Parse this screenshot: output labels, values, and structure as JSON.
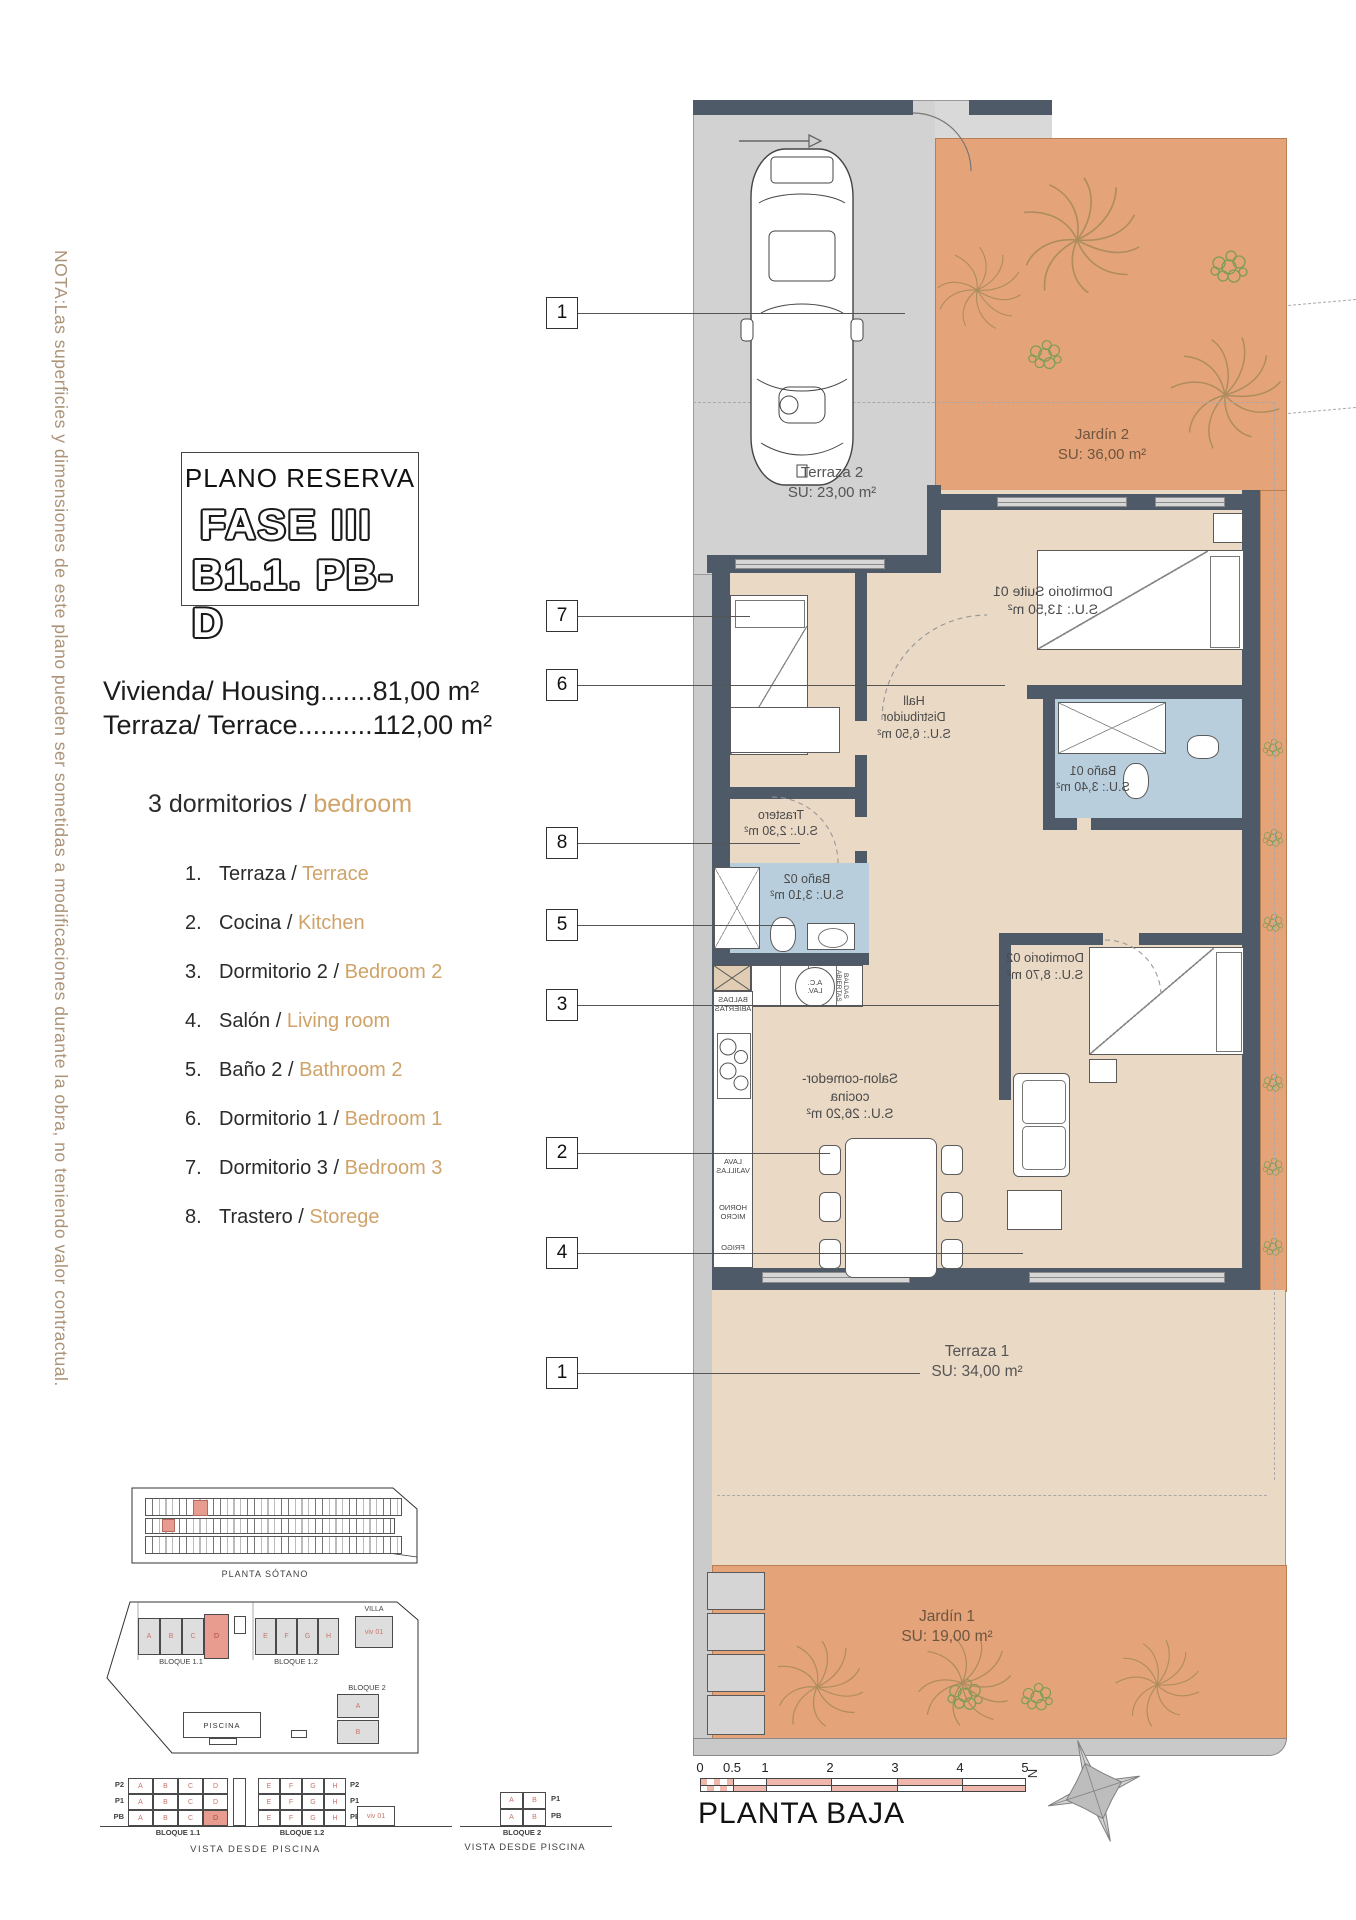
{
  "colors": {
    "garden_orange": "#e5a379",
    "interior_beige": "#ead9c5",
    "bath_blue": "#b9cedd",
    "wall_dark": "#4f5a68",
    "paving_gray": "#d2d2d2",
    "highlight_salmon": "#e89c90",
    "scale_pink": "#efb6ac",
    "legend_english": "#cfa369",
    "note_tan": "#ab9377"
  },
  "note": "NOTA:Las superficies y dimensiones de este plano pueden ser sometidas a modificaciones durante la obra, no teniendo valor contractual.",
  "title_box": {
    "line1": "PLANO RESERVA",
    "line2": "FASE III",
    "line3": "B1.1. PB-D"
  },
  "summary": {
    "housing": "Vivienda/ Housing.......81,00 m²",
    "terrace": "Terraza/ Terrace..........112,00 m²",
    "bedrooms_es": "3 dormitorios / ",
    "bedrooms_en": "bedroom"
  },
  "legend": [
    {
      "num": "1.",
      "es": "Terraza / ",
      "en": "Terrace"
    },
    {
      "num": "2.",
      "es": "Cocina / ",
      "en": "Kitchen"
    },
    {
      "num": "3.",
      "es": "Dormitorio 2 / ",
      "en": "Bedroom 2"
    },
    {
      "num": "4.",
      "es": "Salón / ",
      "en": "Living room"
    },
    {
      "num": "5.",
      "es": "Baño 2 / ",
      "en": "Bathroom 2"
    },
    {
      "num": "6.",
      "es": "Dormitorio 1 / ",
      "en": "Bedroom 1"
    },
    {
      "num": "7.",
      "es": "Dormitorio 3 / ",
      "en": "Bedroom 3"
    },
    {
      "num": "8.",
      "es": "Trastero / ",
      "en": "Storege"
    }
  ],
  "plan": {
    "markers": [
      "1",
      "7",
      "6",
      "8",
      "5",
      "3",
      "2",
      "4",
      "1"
    ],
    "rooms": {
      "terraza2": {
        "name": "Terraza 2",
        "area": "SU: 23,00 m²"
      },
      "jardin2": {
        "name": "Jardín 2",
        "area": "SU: 36,00 m²"
      },
      "suite01": {
        "name": "Dormitorio Suite 01",
        "area": "S.U.: 13,50 m²"
      },
      "hall": {
        "name": "Hall",
        "name2": "Distribuidor",
        "area": "S.U.: 6,50 m²"
      },
      "bano01": {
        "name": "Baño 01",
        "area": "S.U.: 3,40 m²"
      },
      "trastero": {
        "name": "Trastero",
        "area": "S.U.: 2,30 m²"
      },
      "bano02": {
        "name": "Baño 02",
        "area": "S.U.: 3,10 m²"
      },
      "dorm02": {
        "name": "Dormitorio 02",
        "area": "S.U.: 8,70 m²"
      },
      "salon": {
        "name": "Salon-comedor-cocina",
        "area": "S.U.: 26,20 m²"
      },
      "terraza1": {
        "name": "Terraza 1",
        "area": "SU: 34,00 m²"
      },
      "jardin1": {
        "name": "Jardín 1",
        "area": "SU: 19,00 m²"
      }
    },
    "kitchen": {
      "baldas": "BALDAS ABIERTAS",
      "lavavajillas": "LAVA VAJILLAS",
      "horno": "HORNO MICRO",
      "frigo": "FRIGO",
      "aclav1": "A.C.",
      "aclav2": "LAV."
    }
  },
  "footer": {
    "scale_ticks": [
      "0",
      "0.5",
      "1",
      "2",
      "3",
      "4",
      "5"
    ],
    "caption": "PLANTA BAJA",
    "north": "N"
  },
  "miniplans": {
    "sotano_label": "PLANTA SÓTANO",
    "bloque11": "BLOQUE 1.1",
    "bloque12": "BLOQUE 1.2",
    "bloque2": "BLOQUE 2",
    "villa": "VILLA",
    "viv01": "viv 01",
    "piscina": "PISCINA",
    "units_left": [
      "A",
      "B",
      "C",
      "D"
    ],
    "units_right": [
      "E",
      "F",
      "G",
      "H"
    ],
    "bloque2_units": [
      "A",
      "B"
    ],
    "floors": [
      "P2",
      "P1",
      "PB"
    ],
    "floors2": [
      "P1",
      "PB"
    ],
    "vista": "VISTA DESDE PISCINA"
  }
}
